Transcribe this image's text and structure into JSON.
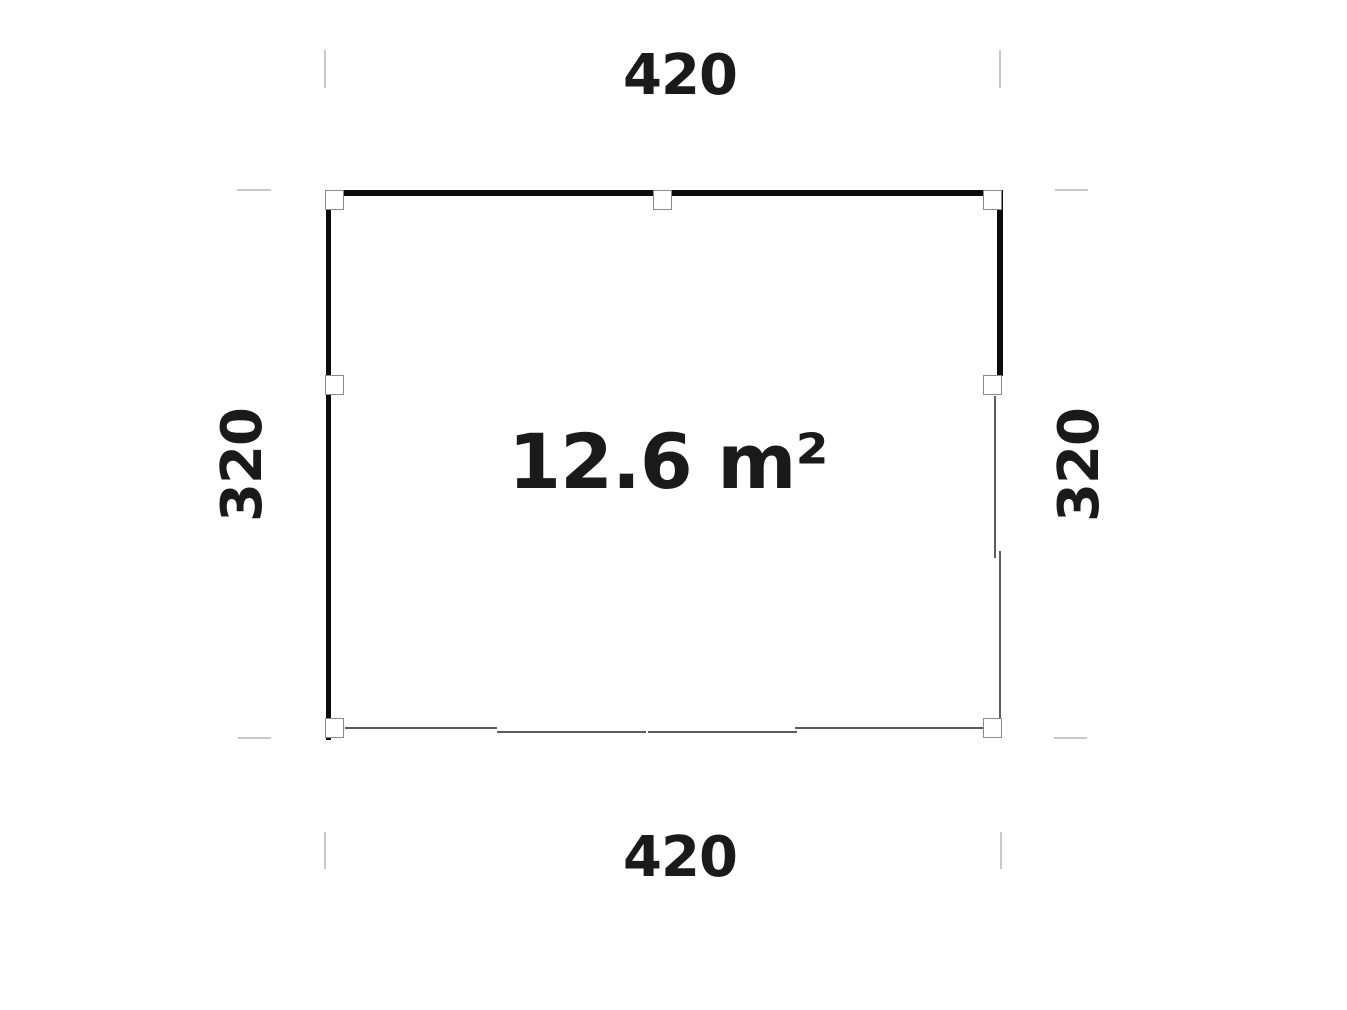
{
  "plan": {
    "title": "gazebo-floor-plan",
    "area_label": "12.6 m²",
    "dimensions": {
      "top": "420",
      "bottom": "420",
      "left": "320",
      "right": "320"
    },
    "structure": {
      "closed_walls": [
        "top",
        "left",
        "right-upper"
      ],
      "open_sides": [
        "bottom",
        "right-lower"
      ],
      "post_count": 7
    },
    "colors": {
      "wall": "#0d0d0d",
      "thin_wall": "#5c5c5c",
      "post_border": "#8a8a8a",
      "tick": "#c9c9c9",
      "text": "#1a1a1a",
      "background": "#ffffff"
    }
  }
}
